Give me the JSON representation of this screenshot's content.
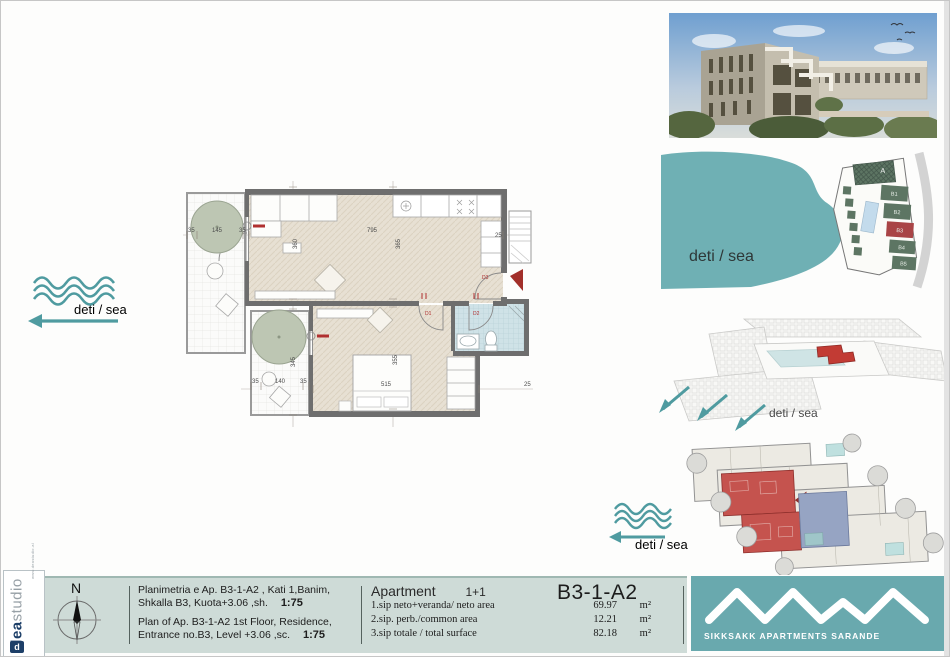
{
  "branding": {
    "dea": "dea",
    "studio": "studio",
    "url": "www.deastudio.al",
    "company": "SIKKSAKK APARTMENTS SARANDE",
    "teal": "#69a9ae",
    "mint": "#cedbd7",
    "red": "#b03030"
  },
  "sea_label": "deti / sea",
  "floor_plan": {
    "dims": {
      "living_w": "795",
      "living_h": "365",
      "bedroom_h": "355",
      "bedroom_w": "515",
      "left_h": "360",
      "balc2_h": "345",
      "balc1_a": "35",
      "balc1_b": "145",
      "balc1_c": "35",
      "balc2_a": "35",
      "balc2_b": "140",
      "balc2_c": "35",
      "kitchen_side": "25",
      "bedroom_side": "25"
    },
    "doors": {
      "d1": "D1",
      "d2": "D2",
      "d3": "D3"
    }
  },
  "site_plan": {
    "blocks": [
      {
        "label": "A"
      },
      {
        "label": "B1"
      },
      {
        "label": "B2"
      },
      {
        "label": "B3"
      },
      {
        "label": "B4"
      },
      {
        "label": "B5"
      }
    ],
    "highlight": "B3"
  },
  "title_block": {
    "north": "N",
    "sq_line1": "Planimetria e Ap. B3-1-A2 , Kati 1,Banim,",
    "sq_line2": "Shkalla B3, Kuota+3.06 ,sh.",
    "sq_scale": "1:75",
    "en_line1": "Plan of Ap. B3-1-A2 1st Floor, Residence,",
    "en_line2": "Entrance no.B3, Level +3.06 ,sc.",
    "en_scale": "1:75",
    "apartment_label": "Apartment",
    "apartment_type": "1+1",
    "unit_code": "B3-1-A2",
    "rows": [
      {
        "label": "1.sip neto+veranda/ neto area",
        "value": "69.97",
        "unit": "m²"
      },
      {
        "label": "2.sip. perb./common area",
        "value": "12.21",
        "unit": "m²"
      },
      {
        "label": "3.sip totale /  total surface",
        "value": "82.18",
        "unit": "m²"
      }
    ]
  }
}
